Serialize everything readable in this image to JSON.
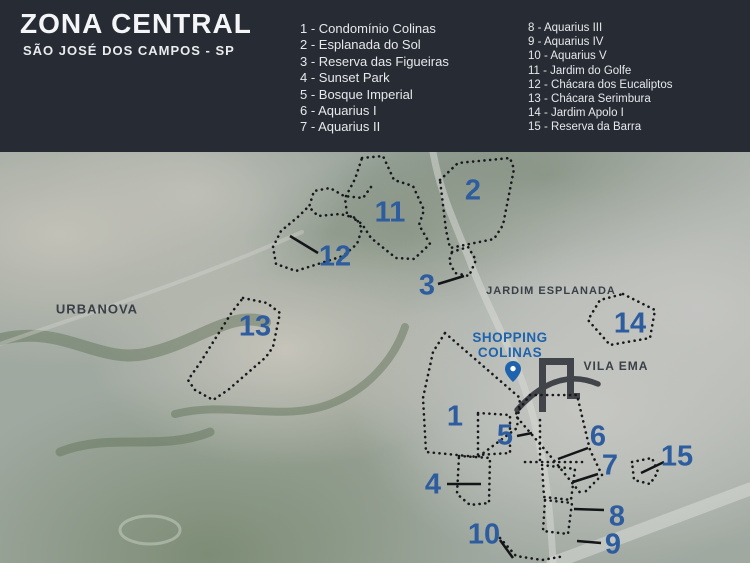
{
  "header": {
    "title": "ZONA CENTRAL",
    "subtitle": "SÃO JOSÉ DOS CAMPOS - SP",
    "legend_col1": [
      "1 - Condomínio Colinas",
      "2 - Esplanada do Sol",
      "3 - Reserva das Figueiras",
      "4 - Sunset Park",
      "5 - Bosque Imperial",
      "6 - Aquarius I",
      "7 - Aquarius II"
    ],
    "legend_col2": [
      "8 - Aquarius III",
      "9 - Aquarius IV",
      "10 - Aquarius V",
      "11 - Jardim do Golfe",
      "12 - Chácara dos Eucaliptos",
      "13 - Chácara Serimbura",
      "14 - Jardim Apolo I",
      "15 - Reserva da Barra"
    ]
  },
  "map": {
    "area_labels": {
      "urbanova": "URBANOVA",
      "jardim_esplanada": "JARDIM ESPLANADA",
      "vila_ema": "VILA EMA"
    },
    "poi": {
      "shopping_line1": "SHOPPING",
      "shopping_line2": "COLINAS"
    },
    "markers": [
      {
        "n": "1"
      },
      {
        "n": "2"
      },
      {
        "n": "3"
      },
      {
        "n": "4"
      },
      {
        "n": "5"
      },
      {
        "n": "6"
      },
      {
        "n": "7"
      },
      {
        "n": "8"
      },
      {
        "n": "9"
      },
      {
        "n": "10"
      },
      {
        "n": "11"
      },
      {
        "n": "12"
      },
      {
        "n": "13"
      },
      {
        "n": "14"
      },
      {
        "n": "15"
      }
    ]
  },
  "colors": {
    "header_bg": "#272c34",
    "number_blue": "#2d5d9e",
    "poi_blue": "#1e63ac",
    "outline_black": "#17181b",
    "area_label_dark": "#3a3f48"
  }
}
